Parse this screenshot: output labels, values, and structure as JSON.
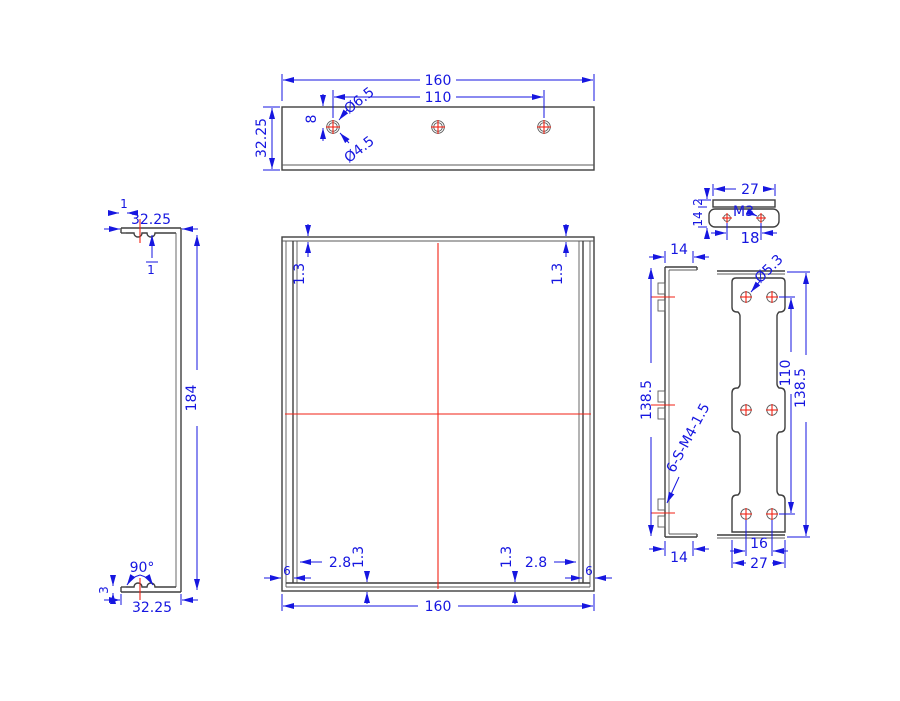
{
  "colors": {
    "object_line": "#3f3f3f",
    "dimension": "#1616e0",
    "centerline": "#f22214",
    "background": "#ffffff"
  },
  "top_view": {
    "width": "160",
    "hole_span": "110",
    "hole_offset": "8",
    "depth": "32.25",
    "cbore_dia": "Ø6.5",
    "hole_dia": "Ø4.5"
  },
  "side_view": {
    "top_width": "32.25",
    "top_lip": "1",
    "top_thickness": "1",
    "height": "184",
    "bend_angle": "90°",
    "bottom_thickness": "3",
    "bottom_width": "32.25"
  },
  "front_view": {
    "top_left_thickness": "1.3",
    "top_right_thickness": "1.3",
    "bottom_left_thickness": "1.3",
    "bottom_right_thickness": "1.3",
    "left_inset": "2.8",
    "right_inset": "2.8",
    "left_edge": "6",
    "right_edge": "6",
    "width": "160"
  },
  "tab_view": {
    "width": "27",
    "thread": "M3",
    "hole_span": "18",
    "lip": "2",
    "depth": "14"
  },
  "profile_view": {
    "top_flange": "14",
    "height": "138.5",
    "standoff_note": "6-S-M4-1.5",
    "bottom_flange": "14"
  },
  "back_view": {
    "hole_dia": "Ø5.3",
    "hole_span_v": "110",
    "height": "138.5",
    "hole_span_h": "16",
    "width": "27"
  }
}
